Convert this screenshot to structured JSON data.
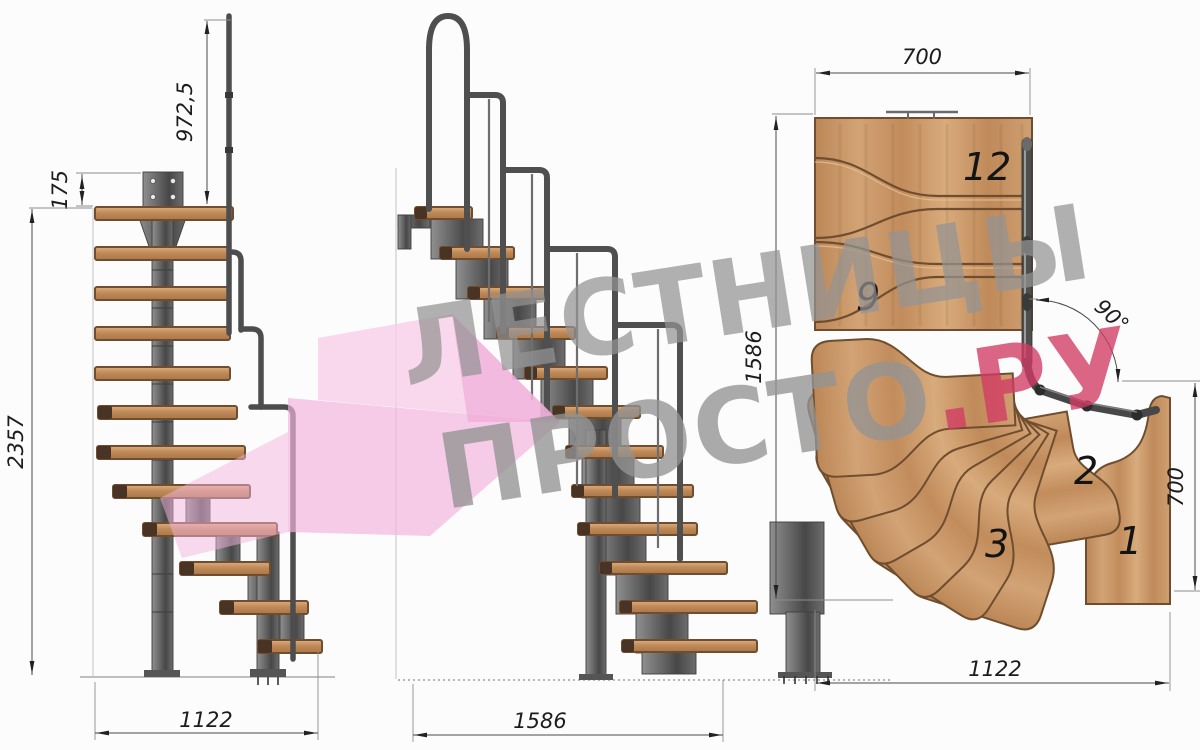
{
  "drawing": {
    "front": {
      "dim_rail_height": "972,5",
      "dim_top_rise": "175",
      "dim_total_height": "2357",
      "dim_width": "1122"
    },
    "side": {
      "dim_length": "1586"
    },
    "plan": {
      "dim_top_width": "700",
      "dim_left_length": "1586",
      "dim_angle": "90°",
      "dim_right_width": "700",
      "dim_bottom_length": "1122",
      "steps": {
        "s12": "12",
        "s9": "9",
        "s3": "3",
        "s2": "2",
        "s1": "1"
      }
    },
    "watermark": {
      "line1": "ЛЕСТНИЦЫ",
      "line2_gray": "ПРОСТО",
      "line2_red": ".РУ"
    },
    "colors": {
      "wood": "#c9956a",
      "wood_dark": "#6b4a2c",
      "steel": "#5a5a5a",
      "watermark_pink": "#f3b4dd",
      "watermark_red": "#d23b63",
      "watermark_gray": "#949494",
      "dim_lines": "#4a4a4a"
    }
  }
}
